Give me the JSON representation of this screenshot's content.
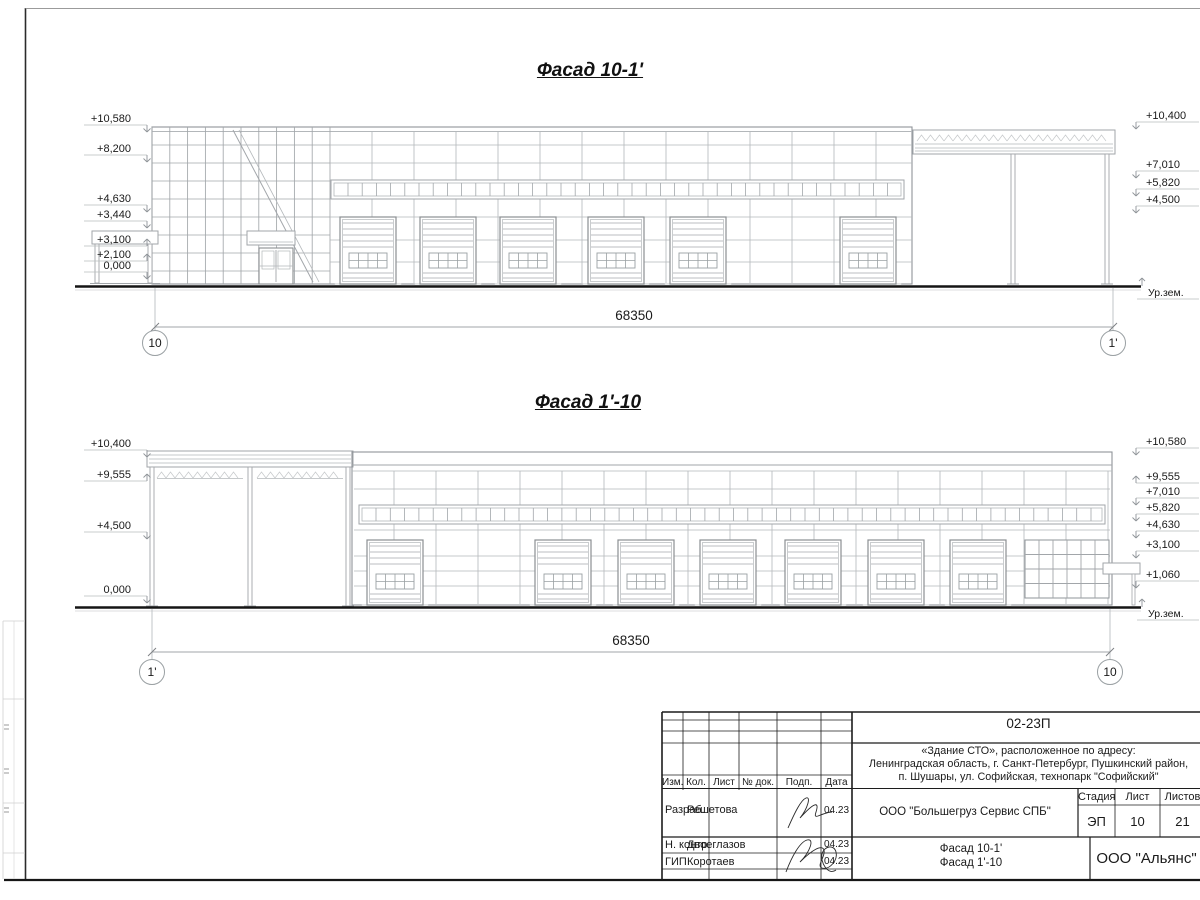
{
  "facade1": {
    "title": "Фасад 10-1'",
    "left_marks": [
      "+10,580",
      "+8,200",
      "+4,630",
      "+3,440",
      "+3,100",
      "+2,100",
      "0,000"
    ],
    "right_marks": [
      "+10,400",
      "+7,010",
      "+5,820",
      "+4,500"
    ],
    "ground_label": "Ур.зем.",
    "dimension": "68350",
    "axis_left": "10",
    "axis_right": "1'"
  },
  "facade2": {
    "title": "Фасад 1'-10",
    "left_marks": [
      "+10,400",
      "+9,555",
      "+4,500",
      "0,000"
    ],
    "right_marks": [
      "+10,580",
      "+9,555",
      "+7,010",
      "+5,820",
      "+4,630",
      "+3,100",
      "+1,060"
    ],
    "ground_label": "Ур.зем.",
    "dimension": "68350",
    "axis_left": "1'",
    "axis_right": "10"
  },
  "titleblock": {
    "doc_number": "02-23П",
    "address_lines": [
      "«Здание СТО», расположенное по адресу:",
      "Ленинградская область, г. Санкт-Петербург, Пушкинский район,",
      "п. Шушары, ул. Софийская, технопарк \"Софийский\""
    ],
    "columns": [
      "Изм.",
      "Кол.",
      "Лист",
      "№ док.",
      "Подп.",
      "Дата"
    ],
    "rows": [
      {
        "role": "Разраб.",
        "name": "Решетова",
        "date": "04.23"
      },
      {
        "role": "Н. контр.",
        "name": "Двоеглазов",
        "date": "04.23"
      },
      {
        "role": "ГИП",
        "name": "Коротаев",
        "date": "04.23"
      }
    ],
    "client": "ООО \"Большегруз Сервис СПБ\"",
    "stage_label": "Стадия",
    "sheet_label": "Лист",
    "sheets_label": "Листов",
    "stage": "ЭП",
    "sheet_no": "10",
    "sheets_total": "21",
    "sheet_titles": [
      "Фасад 10-1'",
      "Фасад 1'-10"
    ],
    "company": "ООО \"Альянс\""
  }
}
